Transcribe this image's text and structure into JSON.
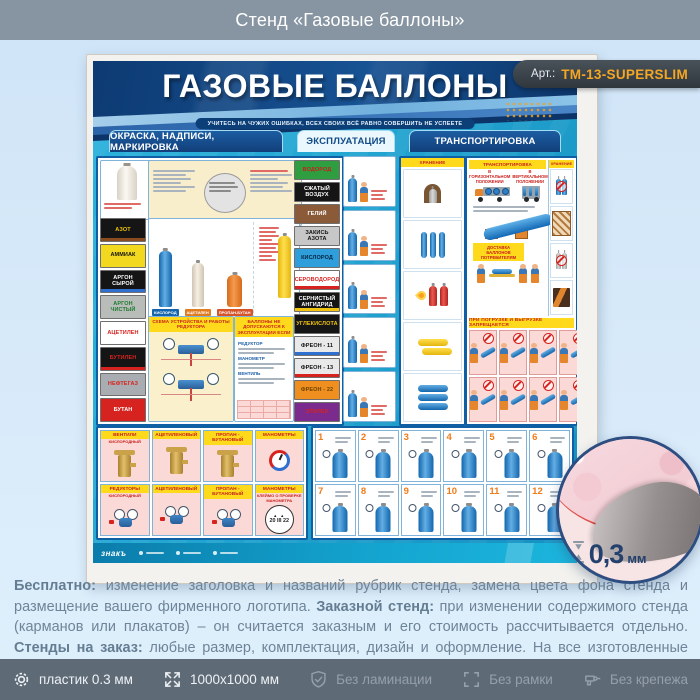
{
  "page_header": {
    "title": "Стенд «Газовые баллоны»"
  },
  "badge": {
    "prefix": "Арт.:",
    "code": "ТМ-13-SUPERSLIM"
  },
  "poster": {
    "title": "ГАЗОВЫЕ БАЛЛОНЫ",
    "quote": "УЧИТЕСЬ НА ЧУЖИХ ОШИБКАХ, ВСЕХ СВОИХ ВСЁ РАВНО СОВЕРШИТЬ НЕ УСПЕЕТЕ",
    "tabs": [
      {
        "label": "ОКРАСКА, НАДПИСИ, МАРКИРОВКА",
        "variant": "dark"
      },
      {
        "label": "ЭКСПЛУАТАЦИЯ",
        "variant": "light"
      },
      {
        "label": "ТРАНСПОРТИРОВКА",
        "variant": "dark"
      }
    ],
    "gas_labels_left": [
      {
        "label": "АЗОТ",
        "bg": "#151515",
        "fg": "#f1c40f",
        "stripe": "#8a4b1f"
      },
      {
        "label": "АММИАК",
        "bg": "#f2d91f",
        "fg": "#111111"
      },
      {
        "label": "АРГОН СЫРОЙ",
        "bg": "#151515",
        "fg": "#ffffff",
        "stripe": "#2e6fd0"
      },
      {
        "label": "АРГОН ЧИСТЫЙ",
        "bg": "#b9bdb9",
        "fg": "#1d7a2e"
      },
      {
        "label": "АЦЕТИЛЕН",
        "bg": "#ffffff",
        "fg": "#d6231f"
      },
      {
        "label": "БУТИЛЕН",
        "bg": "#151515",
        "fg": "#d6231f",
        "stripe": "#d6231f"
      },
      {
        "label": "НЕФТЕГАЗ",
        "bg": "#a9adb1",
        "fg": "#d6231f"
      },
      {
        "label": "БУТАН",
        "bg": "#d6231f",
        "fg": "#ffffff"
      }
    ],
    "gas_labels_right": [
      {
        "label": "ВОДОРОД",
        "bg": "#2f9e41",
        "fg": "#c61f1c"
      },
      {
        "label": "СЖАТЫЙ ВОЗДУХ",
        "bg": "#151515",
        "fg": "#ffffff"
      },
      {
        "label": "ГЕЛИЙ",
        "bg": "#8a5a39",
        "fg": "#ffffff"
      },
      {
        "label": "ЗАКИСЬ АЗОТА",
        "bg": "#c7c7c7",
        "fg": "#111111"
      },
      {
        "label": "КИСЛОРОД",
        "bg": "#2f9fdc",
        "fg": "#07243f"
      },
      {
        "label": "СЕРОВОДОРОД",
        "bg": "#ffffff",
        "fg": "#d6231f",
        "stripe": "#d6231f"
      },
      {
        "label": "СЕРНИСТЫЙ АНГИДРИД",
        "bg": "#151515",
        "fg": "#ffffff",
        "stripe": "#f1c40f"
      },
      {
        "label": "УГЛЕКИСЛОТА",
        "bg": "#151515",
        "fg": "#f1c40f"
      },
      {
        "label": "ФРЕОН - 11",
        "bg": "#e9e9e9",
        "fg": "#111111",
        "stripe": "#2e6fd0"
      },
      {
        "label": "ФРЕОН - 13",
        "bg": "#e9e9e9",
        "fg": "#111111",
        "stripe": "#d6231f"
      },
      {
        "label": "ФРЕОН - 22",
        "bg": "#ef8f1f",
        "fg": "#6b4300"
      },
      {
        "label": "ЭТИЛЕН",
        "bg": "#7a2b8d",
        "fg": "#d6231f"
      }
    ],
    "sections": {
      "cylinder_names": [
        "КИСЛОРОД",
        "АЦЕТИЛЕН",
        "ПРОПАН-БУТАН"
      ],
      "schema_title": "СХЕМА УСТРОЙСТВА И РАБОТЫ РЕДУКТОРА",
      "not_allowed_title": "БАЛЛОНЫ НЕ ДОПУСКАЮТСЯ К ЭКСПЛУАТАЦИИ ЕСЛИ",
      "not_allowed_items": [
        "РЕДУКТОР",
        "МАНОМЕТР",
        "ВЕНТИЛЬ"
      ],
      "storage_title": "ХРАНЕНИЕ",
      "transport_title": "ТРАНСПОРТИРОВКА",
      "transport_sub_left": "В ГОРИЗОНТАЛЬНОМ ПОЛОЖЕНИИ",
      "transport_sub_right": "В ВЕРТИКАЛЬНОМ ПОЛОЖЕНИИ",
      "delivery_label": "ДОСТАВКА БАЛЛОНОВ ПОТРЕБИТЕЛЯМ",
      "loading_banner": "ПРИ ПОГРУЗКЕ И ВЫГРУЗКЕ ЗАПРЕЩАЕТСЯ",
      "storage2_title": "ХРАНЕНИЕ"
    },
    "equipment": [
      {
        "title": "ВЕНТИЛИ",
        "sub": "КИСЛОРОДНЫЙ",
        "icon": "valve"
      },
      {
        "title": "АЦЕТИЛЕНОВЫЙ",
        "icon": "valve"
      },
      {
        "title": "ПРОПАН - БУТАНОВЫЙ",
        "icon": "valve"
      },
      {
        "title": "МАНОМЕТРЫ",
        "icon": "gauge"
      },
      {
        "title": "РЕДУКТОРЫ",
        "sub": "КИСЛОРОДНЫЙ",
        "icon": "regulator"
      },
      {
        "title": "АЦЕТИЛЕНОВЫЙ",
        "icon": "regulator"
      },
      {
        "title": "ПРОПАН - БУТАНОВЫЙ",
        "icon": "regulator"
      },
      {
        "title": "МАНОМЕТРЫ",
        "sub": "КЛЕЙМО О ПРОВЕРКЕ МАНОМЕТРА",
        "icon": "stamp",
        "stamp_text": "20 III 22"
      }
    ],
    "steps": [
      "1",
      "2",
      "3",
      "4",
      "5",
      "6",
      "7",
      "8",
      "9",
      "10",
      "11",
      "12"
    ],
    "brand": "знакъ"
  },
  "inset": {
    "value": "0,3",
    "unit": "мм"
  },
  "description": {
    "segments": [
      {
        "b": true,
        "t": "Бесплатно:"
      },
      {
        "b": false,
        "t": " изменение заголовка и названий рубрик стенда, замена цвета фона стенда и размещение вашего фирменного логотипа. "
      },
      {
        "b": true,
        "t": "Заказной стенд:"
      },
      {
        "b": false,
        "t": " при изменении содержимого стенда (карманов или плакатов) – он считается заказным и его стоимость рассчитывается отдельно. "
      },
      {
        "b": true,
        "t": "Стенды на заказ:"
      },
      {
        "b": false,
        "t": " любые размер, комплектация, дизайн и оформление. На все изготовленные стенды даем 2 года гарантии. Выгодно, эстетично и надежно!"
      }
    ]
  },
  "bottom_bar": {
    "items": [
      {
        "icon": "gear-icon",
        "label": "пластик 0.3 мм",
        "muted": false
      },
      {
        "icon": "resize-icon",
        "label": "1000х1000 мм",
        "muted": false
      },
      {
        "icon": "shield-check-icon",
        "label": "Без ламинации",
        "muted": true
      },
      {
        "icon": "frame-icon",
        "label": "Без рамки",
        "muted": true
      },
      {
        "icon": "fastener-icon",
        "label": "Без крепежа",
        "muted": true
      }
    ]
  },
  "colors": {
    "accent_orange": "#f5a623",
    "poster_navy": "#0d3a72",
    "poster_teal": "#1ba3d1",
    "header_gray": "#8795a2",
    "bottom_bar": "#5e6a76",
    "panel_border": "#0e5fa4",
    "header_yellow": "#ffd91c",
    "header_red": "#c9201d",
    "panel_pink": "#fbd9d6"
  }
}
